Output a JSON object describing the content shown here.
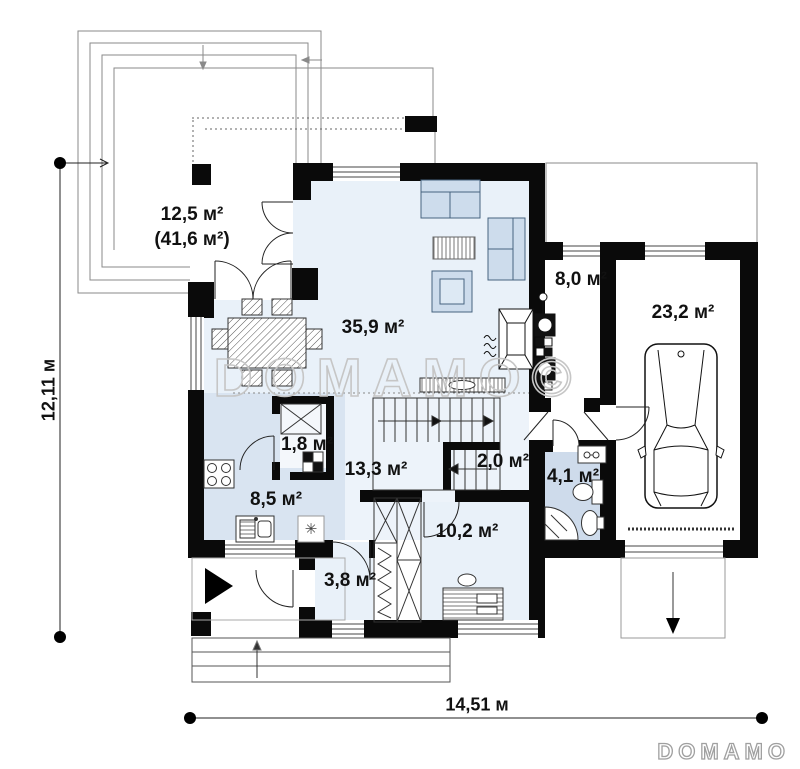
{
  "rooms": {
    "terrace": {
      "area": "12,5 м²",
      "total": "(41,6 м²)"
    },
    "living": {
      "area": "35,9 м²"
    },
    "boiler": {
      "area": "8,0 м²"
    },
    "garage": {
      "area": "23,2 м²"
    },
    "pantry": {
      "area": "1,8 м²"
    },
    "kitchen": {
      "area": "8,5 м²"
    },
    "hall": {
      "area": "13,3 м²"
    },
    "stairs": {
      "area": "2,0 м²"
    },
    "bathroom": {
      "area": "4,1 м²"
    },
    "cabinet": {
      "area": "10,2 м²"
    },
    "vestibule": {
      "area": "3,8 м²"
    }
  },
  "dimensions": {
    "height": "12,11 м",
    "width": "14,51 м"
  },
  "watermark": {
    "center": "DOMAMO©",
    "logo": "DOMAMO"
  },
  "icons": {
    "snowflake": "✳"
  },
  "colors": {
    "wall": "#0a0a0a",
    "floor": "#e9f1f9",
    "floor_kitchen": "#d9e4f1",
    "floor_bath": "#cedbeb",
    "furniture_fill": "#cddcec",
    "furniture_stroke": "#47637f",
    "watermark": "#c6c6c6"
  }
}
